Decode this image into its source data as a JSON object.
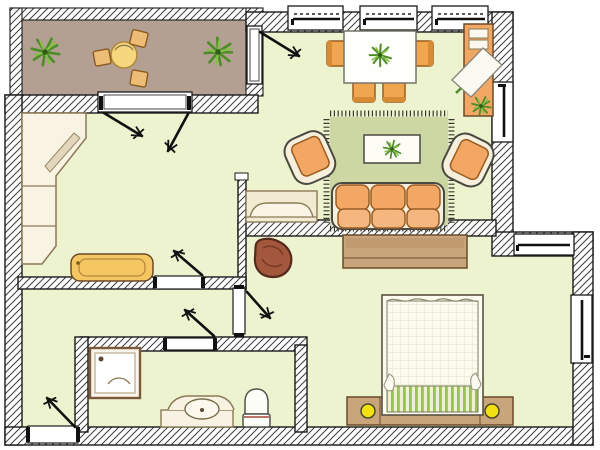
{
  "diagram": {
    "type": "apartment-floor-plan",
    "rooms": [
      {
        "name": "balcony",
        "furniture": [
          "round-table",
          "stool",
          "stool",
          "stool",
          "potted-plant",
          "potted-plant"
        ]
      },
      {
        "name": "dining-area",
        "furniture": [
          "dining-table",
          "dining-chair",
          "dining-chair",
          "dining-chair",
          "dining-chair",
          "sideboard",
          "drawing-board",
          "potted-plant"
        ]
      },
      {
        "name": "living-area",
        "furniture": [
          "rug",
          "coffee-table",
          "sofa",
          "armchair",
          "armchair",
          "bench-seat"
        ]
      },
      {
        "name": "kitchen",
        "furniture": [
          "l-shaped-counter",
          "cutting-board",
          "kitchen-bench"
        ]
      },
      {
        "name": "hallway",
        "furniture": []
      },
      {
        "name": "bathroom",
        "furniture": [
          "shower",
          "washbasin",
          "toilet"
        ]
      },
      {
        "name": "bedroom",
        "furniture": [
          "double-bed",
          "headboard-with-nightstands",
          "bedside-lamp",
          "bedside-lamp",
          "wardrobe",
          "pouf"
        ]
      }
    ],
    "window_count": 8,
    "door_count": 7
  },
  "colors": {
    "floor": "#edf2cf",
    "balcony_floor": "#b3a092",
    "wall_line": "#1a1a1a",
    "furniture_orange": "#f2a765",
    "seat_orange_light": "#f5b67f",
    "wood_tan": "#c9a57c",
    "rug_green": "#ccd7a3",
    "bench_yellow": "#f4c763",
    "lamp_yellow": "#f2e013",
    "plant_green": "#4e8c28",
    "bed_stripe_green": "#98c257",
    "pouf_brown": "#a3573c",
    "table_yellow": "#f6d77d"
  }
}
